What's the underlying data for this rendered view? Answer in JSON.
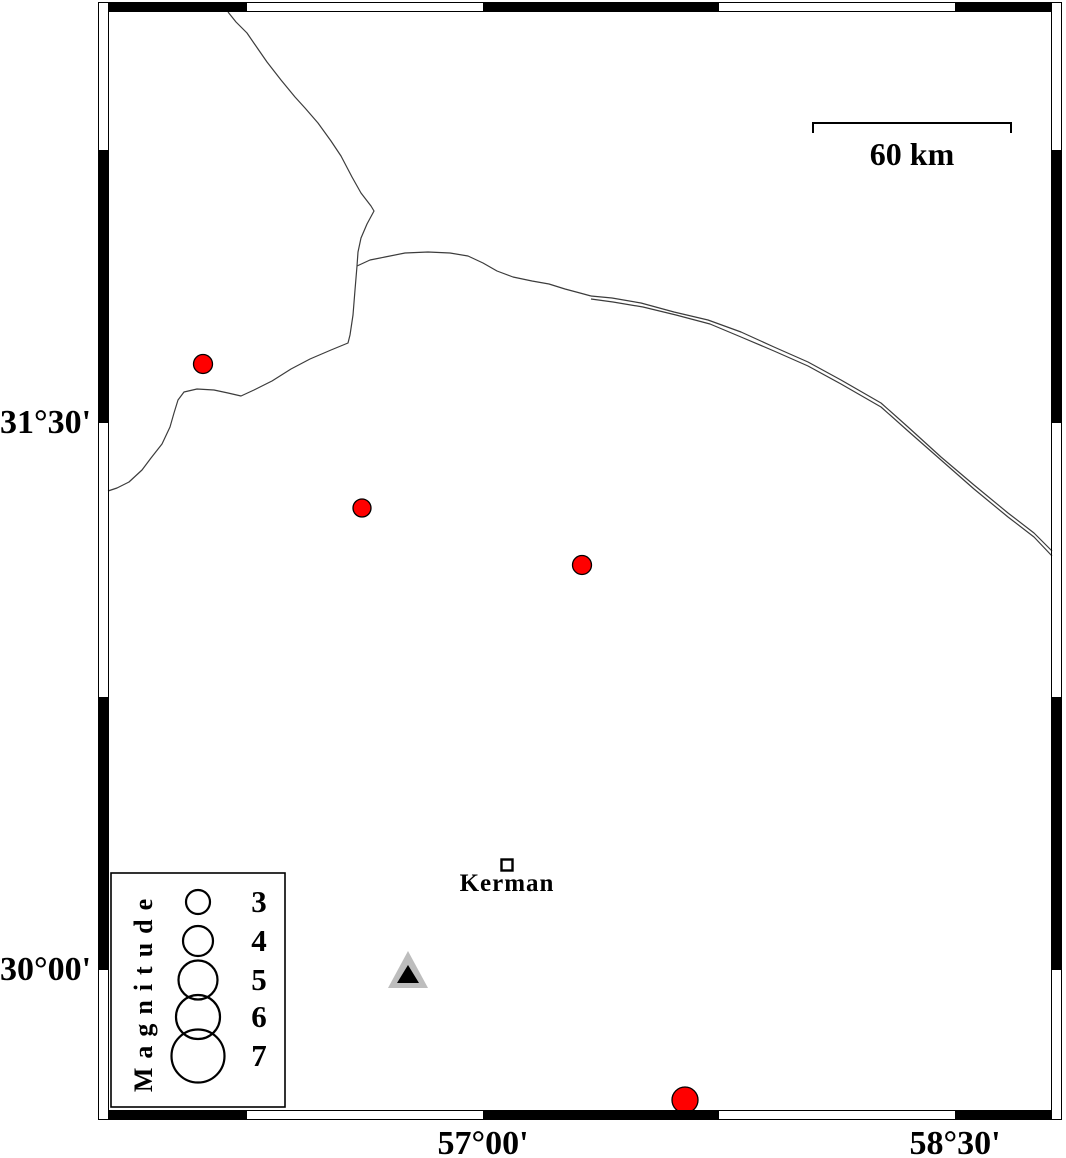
{
  "map_frame": {
    "left_labels": [
      {
        "text": "31°30'",
        "y": 423
      },
      {
        "text": "30°00'",
        "y": 970
      }
    ],
    "bottom_labels": [
      {
        "text": "57°00'",
        "x": 483
      },
      {
        "text": "58°30'",
        "x": 955
      }
    ]
  },
  "scale_bar": {
    "label": "60 km"
  },
  "legend": {
    "title": "Magnitude",
    "circle_cx": 198,
    "entries": [
      {
        "label": "3",
        "y": 902,
        "radius": 12
      },
      {
        "label": "4",
        "y": 941,
        "radius": 15
      },
      {
        "label": "5",
        "y": 980,
        "radius": 19.5
      },
      {
        "label": "6",
        "y": 1017,
        "radius": 22
      },
      {
        "label": "7",
        "y": 1056,
        "radius": 26.5
      }
    ]
  },
  "city": {
    "name": "Kerman",
    "x": 507,
    "y": 865
  },
  "station": {
    "outer": [
      [
        408,
        951
      ],
      [
        388,
        988
      ],
      [
        428,
        988
      ]
    ],
    "inner": [
      [
        408,
        965
      ],
      [
        397,
        983
      ],
      [
        419,
        983
      ]
    ]
  },
  "earthquakes": [
    {
      "x": 203,
      "y": 364,
      "r": 9.5
    },
    {
      "x": 362,
      "y": 508,
      "r": 9
    },
    {
      "x": 582,
      "y": 565,
      "r": 9.5
    },
    {
      "x": 685,
      "y": 1100,
      "r": 13
    }
  ],
  "colors": {
    "earthquake_fill": "#ff0000",
    "marker_outline": "#000000",
    "station_fill": "#bdbdbd",
    "station_inner": "#000000",
    "border_line": "#3c3c3c",
    "frame": "#000000"
  },
  "border_lines": {
    "western_branch": [
      [
        228,
        12
      ],
      [
        236,
        22
      ],
      [
        247,
        33
      ],
      [
        258,
        49
      ],
      [
        267,
        62
      ],
      [
        281,
        80
      ],
      [
        295,
        97
      ],
      [
        305,
        108
      ],
      [
        318,
        123
      ],
      [
        331,
        141
      ],
      [
        341,
        156
      ],
      [
        352,
        177
      ],
      [
        361,
        193
      ],
      [
        371,
        206
      ],
      [
        374,
        211
      ],
      [
        367,
        224
      ],
      [
        361,
        238
      ],
      [
        358,
        252
      ],
      [
        357,
        266
      ],
      [
        355,
        290
      ],
      [
        353,
        315
      ],
      [
        350,
        335
      ],
      [
        348,
        343
      ],
      [
        331,
        350
      ],
      [
        310,
        359
      ],
      [
        291,
        369
      ],
      [
        272,
        381
      ],
      [
        254,
        390
      ],
      [
        241,
        396
      ],
      [
        228,
        393
      ],
      [
        214,
        390
      ],
      [
        197,
        389
      ],
      [
        184,
        392
      ],
      [
        178,
        400
      ],
      [
        174,
        413
      ],
      [
        170,
        427
      ],
      [
        162,
        444
      ],
      [
        151,
        458
      ],
      [
        142,
        470
      ],
      [
        129,
        482
      ],
      [
        117,
        488
      ],
      [
        108,
        491
      ]
    ],
    "main_branch": [
      [
        357,
        266
      ],
      [
        370,
        260
      ],
      [
        385,
        257
      ],
      [
        405,
        253
      ],
      [
        428,
        252
      ],
      [
        450,
        253
      ],
      [
        468,
        256
      ],
      [
        483,
        263
      ],
      [
        497,
        271
      ],
      [
        513,
        277
      ],
      [
        532,
        281
      ],
      [
        549,
        284
      ],
      [
        565,
        289
      ],
      [
        580,
        293
      ],
      [
        591,
        296
      ]
    ],
    "main_upper": [
      [
        591,
        296
      ],
      [
        612,
        298
      ],
      [
        641,
        303
      ],
      [
        674,
        312
      ],
      [
        708,
        320
      ],
      [
        741,
        332
      ],
      [
        774,
        347
      ],
      [
        808,
        362
      ],
      [
        841,
        380
      ],
      [
        881,
        403
      ],
      [
        908,
        427
      ],
      [
        941,
        457
      ],
      [
        974,
        485
      ],
      [
        1008,
        513
      ],
      [
        1034,
        533
      ],
      [
        1052,
        551
      ]
    ],
    "main_lower": [
      [
        591,
        299
      ],
      [
        613,
        302
      ],
      [
        643,
        307
      ],
      [
        676,
        315
      ],
      [
        710,
        324
      ],
      [
        741,
        337
      ],
      [
        774,
        351
      ],
      [
        808,
        366
      ],
      [
        841,
        384
      ],
      [
        881,
        407
      ],
      [
        908,
        431
      ],
      [
        941,
        460
      ],
      [
        974,
        489
      ],
      [
        1008,
        517
      ],
      [
        1034,
        537
      ],
      [
        1052,
        556
      ]
    ]
  }
}
